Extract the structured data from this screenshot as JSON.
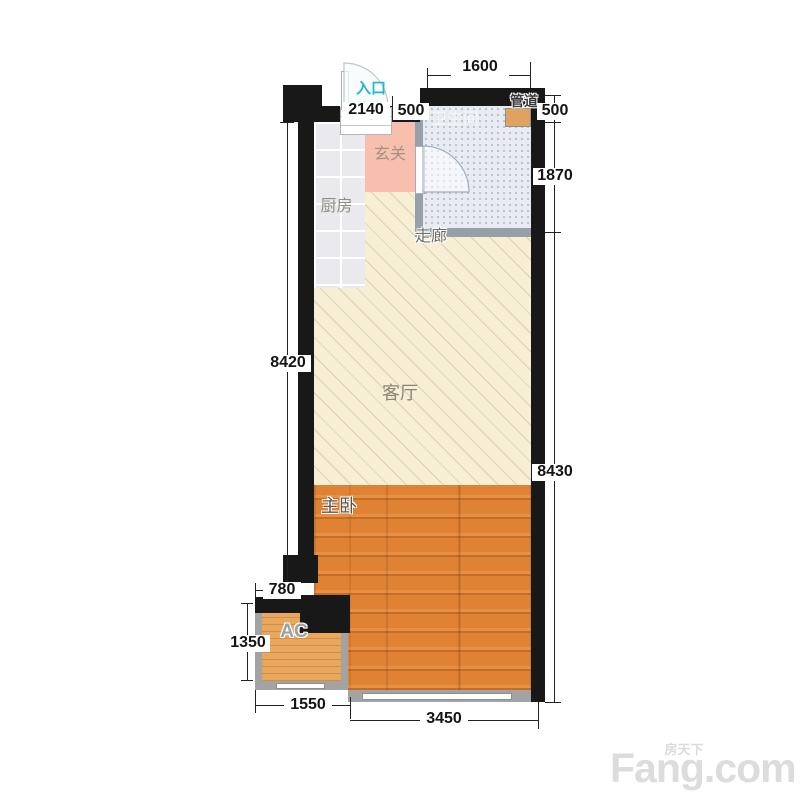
{
  "rooms": {
    "kitchen": "厨房",
    "foyer": "玄关",
    "bathroom": "卫生间",
    "duct": "管道",
    "corridor": "走廊",
    "living": "客厅",
    "bedroom": "主卧",
    "ac": "AC"
  },
  "entry": {
    "label": "入口",
    "direction": "down"
  },
  "dims": {
    "bath_width": "1600",
    "entry_wall": "2140",
    "entry_gap": "500",
    "right_top": "500",
    "bath_height": "1870",
    "right_total": "8430",
    "left_total": "8420",
    "ac_offset": "780",
    "ac_height": "1350",
    "bottom_ac": "1550",
    "bottom_bedroom": "3450"
  },
  "watermark": {
    "cn": "房天下",
    "en": "Fang.com"
  },
  "colors": {
    "wall": "#181818",
    "partition_gray": "#a3a3a3",
    "bath_partition": "#97a0a8",
    "living_floor": "#f7efd5",
    "bedroom_floor": "#e08234",
    "ac_floor": "#e8a75c",
    "kitchen_floor": "#eaeaee",
    "bathroom_floor": "#e8ecf2",
    "foyer_floor": "#f8bfae",
    "duct_fill": "#dfa35f",
    "entry_teal": "#28b5c4",
    "dim_text": "#141414",
    "watermark_gray": "#dcdcdc"
  }
}
